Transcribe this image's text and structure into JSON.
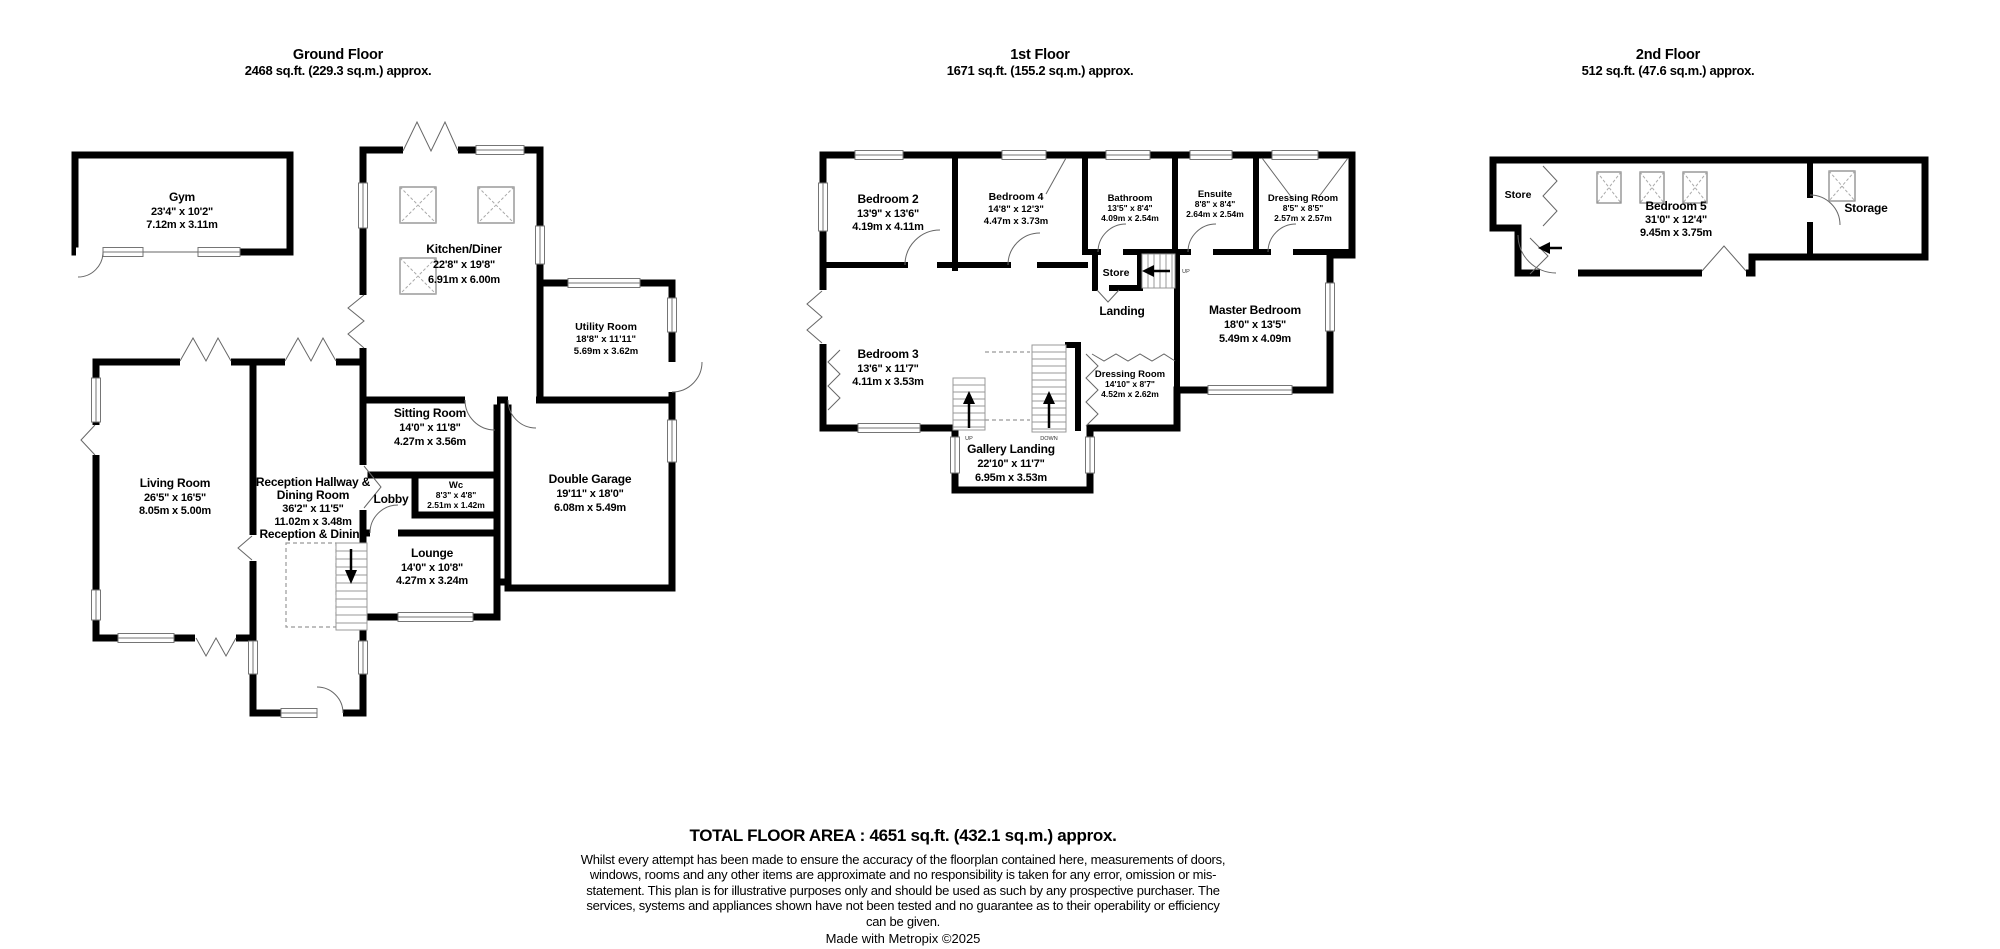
{
  "floors": [
    {
      "title": "Ground Floor",
      "area": "2468 sq.ft. (229.3 sq.m.) approx.",
      "rooms": {
        "gym": {
          "name": "Gym",
          "imperial": "23'4\" x 10'2\"",
          "metric": "7.12m x 3.11m"
        },
        "kitchen": {
          "name": "Kitchen/Diner",
          "imperial": "22'8\" x 19'8\"",
          "metric": "6.91m x 6.00m"
        },
        "utility": {
          "name": "Utility Room",
          "imperial": "18'8\" x 11'11\"",
          "metric": "5.69m x 3.62m"
        },
        "sitting": {
          "name": "Sitting Room",
          "imperial": "14'0\" x 11'8\"",
          "metric": "4.27m x 3.56m"
        },
        "living": {
          "name": "Living Room",
          "imperial": "26'5\" x 16'5\"",
          "metric": "8.05m x 5.00m"
        },
        "reception": {
          "name1": "Reception Hallway &",
          "name2": "Dining Room",
          "imperial": "36'2\" x 11'5\"",
          "metric": "11.02m x 3.48m",
          "note": "Reception & Dining"
        },
        "lobby": {
          "name": "Lobby"
        },
        "wc": {
          "name": "Wc",
          "imperial": "8'3\" x 4'8\"",
          "metric": "2.51m x 1.42m"
        },
        "garage": {
          "name": "Double Garage",
          "imperial": "19'11\" x 18'0\"",
          "metric": "6.08m x 5.49m"
        },
        "lounge": {
          "name": "Lounge",
          "imperial": "14'0\" x 10'8\"",
          "metric": "4.27m x 3.24m"
        }
      }
    },
    {
      "title": "1st Floor",
      "area": "1671 sq.ft. (155.2 sq.m.) approx.",
      "rooms": {
        "bedroom2": {
          "name": "Bedroom 2",
          "imperial": "13'9\" x 13'6\"",
          "metric": "4.19m x 4.11m"
        },
        "bedroom4": {
          "name": "Bedroom 4",
          "imperial": "14'8\" x 12'3\"",
          "metric": "4.47m x 3.73m"
        },
        "bathroom": {
          "name": "Bathroom",
          "imperial": "13'5\" x 8'4\"",
          "metric": "4.09m x 2.54m"
        },
        "ensuite": {
          "name": "Ensuite",
          "imperial": "8'8\" x 8'4\"",
          "metric": "2.64m x 2.54m"
        },
        "dressing1": {
          "name": "Dressing Room",
          "imperial": "8'5\" x 8'5\"",
          "metric": "2.57m x 2.57m"
        },
        "store": {
          "name": "Store"
        },
        "landing": {
          "name": "Landing"
        },
        "master": {
          "name": "Master Bedroom",
          "imperial": "18'0\" x 13'5\"",
          "metric": "5.49m x 4.09m"
        },
        "bedroom3": {
          "name": "Bedroom 3",
          "imperial": "13'6\" x 11'7\"",
          "metric": "4.11m x 3.53m"
        },
        "dressing2": {
          "name": "Dressing Room",
          "imperial": "14'10\" x 8'7\"",
          "metric": "4.52m x 2.62m"
        },
        "gallery": {
          "name": "Gallery Landing",
          "imperial": "22'10\" x 11'7\"",
          "metric": "6.95m x 3.53m"
        }
      },
      "labels": {
        "up": "UP",
        "down": "DOWN"
      }
    },
    {
      "title": "2nd Floor",
      "area": "512 sq.ft. (47.6 sq.m.) approx.",
      "rooms": {
        "store": {
          "name": "Store"
        },
        "bedroom5": {
          "name": "Bedroom 5",
          "imperial": "31'0\" x 12'4\"",
          "metric": "9.45m x 3.75m"
        },
        "storage": {
          "name": "Storage"
        }
      }
    }
  ],
  "footer": {
    "total": "TOTAL FLOOR AREA : 4651 sq.ft. (432.1 sq.m.) approx.",
    "disclaimer": "Whilst every attempt has been made to ensure the accuracy of the floorplan contained here, measurements of doors, windows, rooms and any other items are approximate and no responsibility is taken for any error, omission or mis-statement. This plan is for illustrative purposes only and should be used as such by any prospective purchaser. The services, systems and appliances shown have not been tested and no guarantee as to their operability or efficiency can be given.",
    "credit": "Made with Metropix ©2025"
  }
}
